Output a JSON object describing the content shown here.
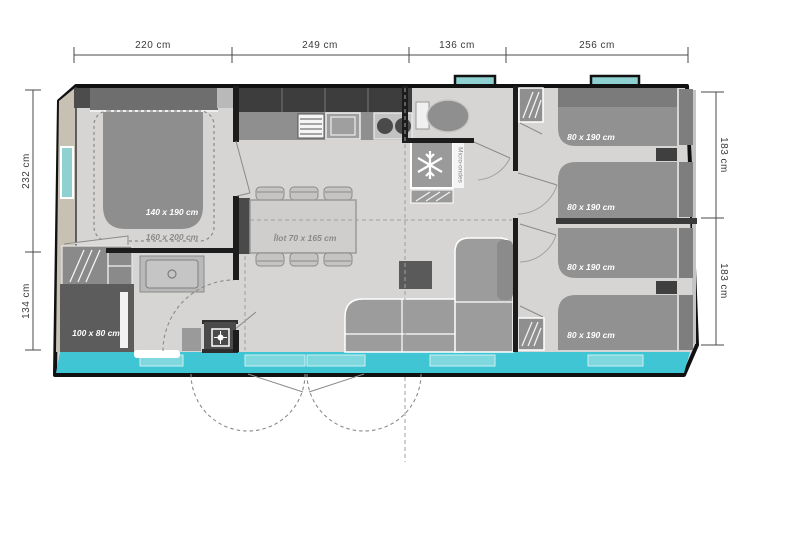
{
  "plan": {
    "type": "mobile-home floor plan",
    "dimensions": {
      "top": [
        "220 cm",
        "249 cm",
        "136 cm",
        "256 cm"
      ],
      "left": [
        "232 cm",
        "134 cm"
      ],
      "right": [
        "183 cm",
        "183 cm"
      ]
    },
    "labels": {
      "master_bed": "140 x 190 cm",
      "master_bed_max": "160 x 200 cm",
      "shower": "100 x 80 cm",
      "island": "Îlot 70 x 165 cm",
      "microwave": "Micro-ondes",
      "single_bed": "80 x 190 cm"
    },
    "colors": {
      "floor": "#d6d5d3",
      "wall": "#1c1c1c",
      "accent_cyan": "#3fc5d4",
      "window_pane": "#7fd8de",
      "window_teal": "#8fd0d0",
      "left_band_beige": "#c7c1b3",
      "furniture_gray": "#9a9a9a",
      "furniture_dark": "#4a4a4a"
    }
  }
}
